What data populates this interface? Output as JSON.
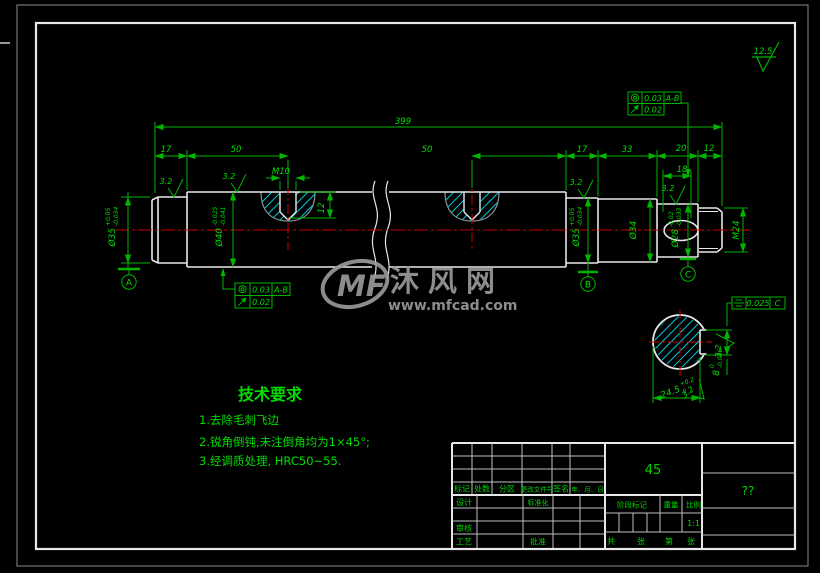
{
  "watermark": {
    "logo": "MF",
    "name": "沐风网",
    "url": "www.mfcad.com"
  },
  "finish": {
    "general": "12.5",
    "fine": "3.2"
  },
  "dims": {
    "overall": "399",
    "len17_left": "17",
    "len50_left": "50",
    "len50_right": "50",
    "len17_right": "17",
    "len33": "33",
    "len20": "20",
    "len12": "12",
    "len18": "18",
    "hole_thread": "M10",
    "hole_depth": "12",
    "dia35_left": {
      "d": "Ø35",
      "up": "+0.05",
      "dn": "-0.034"
    },
    "dia40": {
      "d": "Ø40",
      "up": "-0.025",
      "dn": "-0.041"
    },
    "dia35_right": {
      "d": "Ø35",
      "up": "+0.05",
      "dn": "-0.034"
    },
    "dia34": "Ø34",
    "dia28": {
      "d": "Ø28",
      "up": "-0.02",
      "dn": "-0.033"
    },
    "thread_end": "M24",
    "key_width": {
      "d": "24.5",
      "up": "+0.2",
      "dn": "0"
    },
    "key_depth": {
      "d": "8",
      "up": "0",
      "dn": "-0.036"
    }
  },
  "gdt": {
    "right": {
      "r1": {
        "symbol": "concentricity",
        "value": "0.03",
        "datum": "A-B"
      },
      "r2": {
        "symbol": "circular-runout",
        "value": "0.02"
      }
    },
    "left": {
      "r1": {
        "symbol": "concentricity",
        "value": "0.03",
        "datum": "A-B"
      },
      "r2": {
        "symbol": "circular-runout",
        "value": "0.02"
      }
    },
    "section": {
      "symbol": "symmetry",
      "value": "0.025",
      "datum": "C"
    }
  },
  "datums": {
    "a": "A",
    "b": "B",
    "c": "C"
  },
  "tech": {
    "title": "技术要求",
    "items": [
      "1.去除毛刺飞边",
      "2.锐角倒钝,未注倒角均为1×45°;",
      "3.经调质处理, HRC50~55."
    ]
  },
  "tb": {
    "rev_headers": [
      "标记",
      "处数",
      "分区",
      "更改文件号",
      "签名",
      "年、月、日"
    ],
    "design": "设计",
    "standardization": "标准化",
    "review": "审核",
    "process": "工艺",
    "approve": "批准",
    "material": "45",
    "stage": "阶段标记",
    "weight": "重量",
    "scale": "比例",
    "scale_value": "1:1",
    "sheet_total": "共",
    "sheet_unit1": "张",
    "sheet_no": "第",
    "sheet_unit2": "张",
    "title": "??"
  },
  "colors": {
    "line_green": "#00b400",
    "text_green": "#00dc00",
    "white": "#e8e8e8",
    "red": "#c80000",
    "cyan": "#00c8dc",
    "gray": "#9c9c9c"
  }
}
